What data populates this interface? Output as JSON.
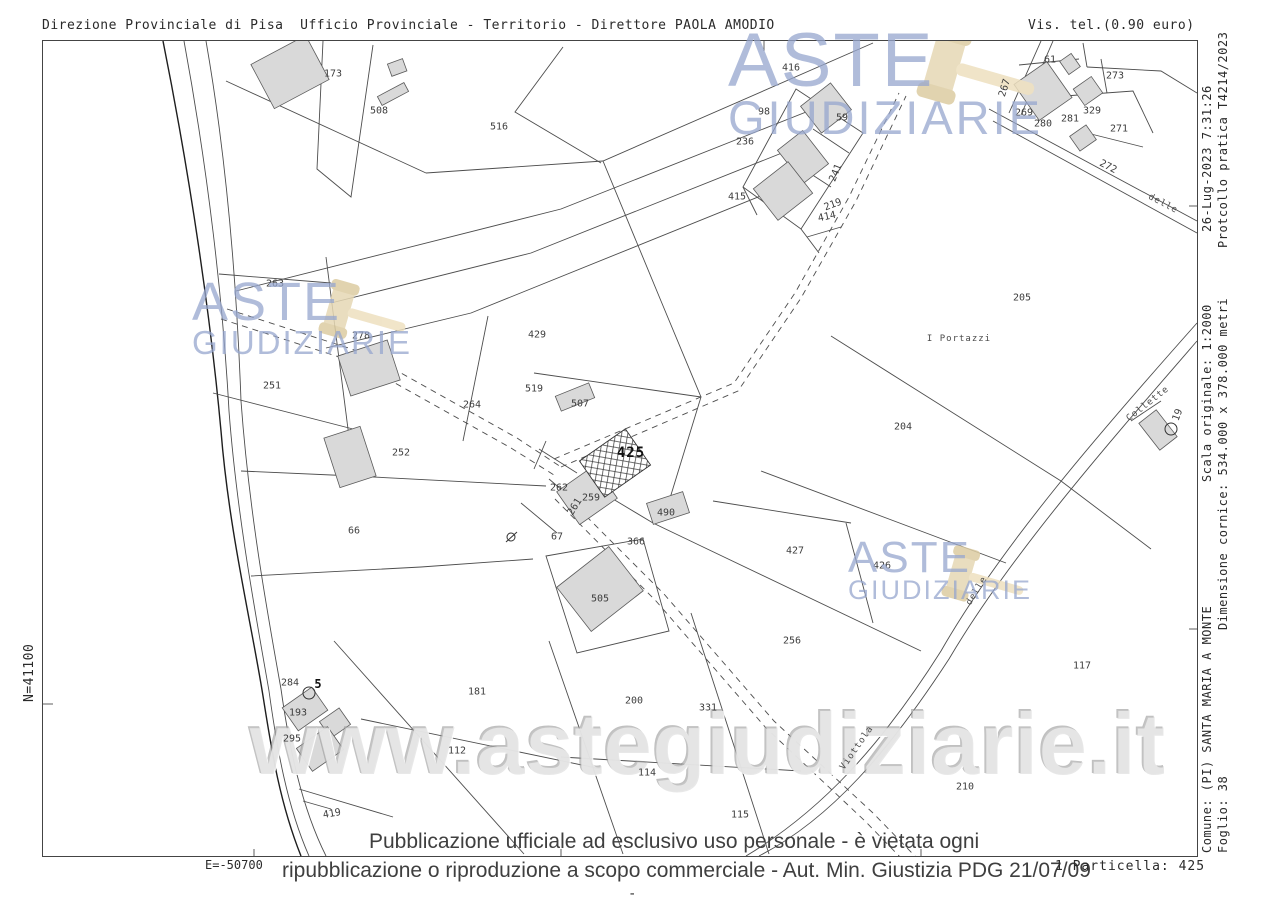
{
  "header": {
    "left": "Direzione Provinciale di Pisa  Ufficio Provinciale - Territorio - Direttore PAOLA AMODIO",
    "right": "Vis. tel.(0.90 euro)"
  },
  "margins": {
    "north": "N=41100",
    "east": "E=-50700"
  },
  "right_margin": {
    "datetime": "26-Lug-2023 7:31:26",
    "protocol": "Protcollo pratica T4214/2023",
    "scale": "Scala originale: 1:2000",
    "frame_size": "Dimensione cornice: 534.000 x 378.000 metri",
    "comune": "Comune: (PI) SANTA MARIA A MONTE",
    "foglio": "Foglio: 38"
  },
  "footer": {
    "line1": "Pubblicazione ufficiale ad esclusivo uso personale - è vietata ogni",
    "line2": "ripubblicazione o riproduzione a scopo commerciale - Aut. Min. Giustizia PDG 21/07/09",
    "particella": "1 Particella: 425",
    "dash": "-"
  },
  "watermarks": {
    "brand_line1": "ASTE",
    "brand_line2": "GIUDIZIARIE",
    "url": "www.astegiudiziarie.it",
    "brand_color": "#96a5cd",
    "gavel_color": "#e6d8b4"
  },
  "map": {
    "highlight_parcel": "425",
    "place_labels": [
      {
        "text": "I Portazzi",
        "x": 958,
        "y": 338
      }
    ],
    "road_labels": [
      {
        "text": "delle",
        "x": 1162,
        "y": 203,
        "rot": 28
      },
      {
        "text": "Collette",
        "x": 1147,
        "y": 403,
        "rot": -38
      },
      {
        "text": "delle",
        "x": 976,
        "y": 590,
        "rot": -58
      },
      {
        "text": "Viottola",
        "x": 856,
        "y": 747,
        "rot": -55
      }
    ],
    "parcels": [
      {
        "id": "173",
        "x": 332,
        "y": 73
      },
      {
        "id": "508",
        "x": 378,
        "y": 110
      },
      {
        "id": "516",
        "x": 498,
        "y": 126
      },
      {
        "id": "416",
        "x": 790,
        "y": 67
      },
      {
        "id": "98",
        "x": 763,
        "y": 111
      },
      {
        "id": "59",
        "x": 841,
        "y": 117
      },
      {
        "id": "236",
        "x": 744,
        "y": 141
      },
      {
        "id": "415",
        "x": 736,
        "y": 196
      },
      {
        "id": "241",
        "x": 835,
        "y": 172,
        "rot": -68
      },
      {
        "id": "219",
        "x": 832,
        "y": 204,
        "rot": -20
      },
      {
        "id": "414",
        "x": 826,
        "y": 216,
        "rot": -12
      },
      {
        "id": "61",
        "x": 1049,
        "y": 59
      },
      {
        "id": "273",
        "x": 1114,
        "y": 75
      },
      {
        "id": "267",
        "x": 1004,
        "y": 87,
        "rot": -72
      },
      {
        "id": "269",
        "x": 1023,
        "y": 112
      },
      {
        "id": "280",
        "x": 1042,
        "y": 123
      },
      {
        "id": "329",
        "x": 1091,
        "y": 110
      },
      {
        "id": "281",
        "x": 1069,
        "y": 118
      },
      {
        "id": "271",
        "x": 1118,
        "y": 128
      },
      {
        "id": "272",
        "x": 1107,
        "y": 166,
        "rot": 27
      },
      {
        "id": "263",
        "x": 274,
        "y": 283
      },
      {
        "id": "278",
        "x": 360,
        "y": 335
      },
      {
        "id": "251",
        "x": 271,
        "y": 385
      },
      {
        "id": "429",
        "x": 536,
        "y": 334
      },
      {
        "id": "519",
        "x": 533,
        "y": 388
      },
      {
        "id": "507",
        "x": 579,
        "y": 403
      },
      {
        "id": "264",
        "x": 471,
        "y": 404
      },
      {
        "id": "252",
        "x": 400,
        "y": 452
      },
      {
        "id": "425",
        "x": 630,
        "y": 452,
        "bold": true
      },
      {
        "id": "262",
        "x": 558,
        "y": 487
      },
      {
        "id": "259",
        "x": 590,
        "y": 497
      },
      {
        "id": "261",
        "x": 574,
        "y": 506,
        "rot": -58
      },
      {
        "id": "490",
        "x": 665,
        "y": 512
      },
      {
        "id": "66",
        "x": 353,
        "y": 530
      },
      {
        "id": "67",
        "x": 556,
        "y": 536
      },
      {
        "id": "366",
        "x": 635,
        "y": 541
      },
      {
        "id": "427",
        "x": 794,
        "y": 550
      },
      {
        "id": "426",
        "x": 881,
        "y": 565
      },
      {
        "id": "204",
        "x": 902,
        "y": 426
      },
      {
        "id": "205",
        "x": 1021,
        "y": 297
      },
      {
        "id": "256",
        "x": 791,
        "y": 640
      },
      {
        "id": "117",
        "x": 1081,
        "y": 665
      },
      {
        "id": "210",
        "x": 964,
        "y": 786
      },
      {
        "id": "200",
        "x": 633,
        "y": 700
      },
      {
        "id": "331",
        "x": 707,
        "y": 707
      },
      {
        "id": "181",
        "x": 476,
        "y": 691
      },
      {
        "id": "112",
        "x": 456,
        "y": 750
      },
      {
        "id": "114",
        "x": 646,
        "y": 772
      },
      {
        "id": "115",
        "x": 739,
        "y": 814
      },
      {
        "id": "419",
        "x": 331,
        "y": 813,
        "rot": -10
      },
      {
        "id": "284",
        "x": 289,
        "y": 682
      },
      {
        "id": "193",
        "x": 297,
        "y": 712
      },
      {
        "id": "295",
        "x": 291,
        "y": 738
      },
      {
        "id": "5",
        "x": 317,
        "y": 683,
        "small_bold": true
      },
      {
        "id": "505",
        "x": 599,
        "y": 598
      },
      {
        "id": "19",
        "x": 1177,
        "y": 414,
        "rot": -70
      }
    ]
  }
}
